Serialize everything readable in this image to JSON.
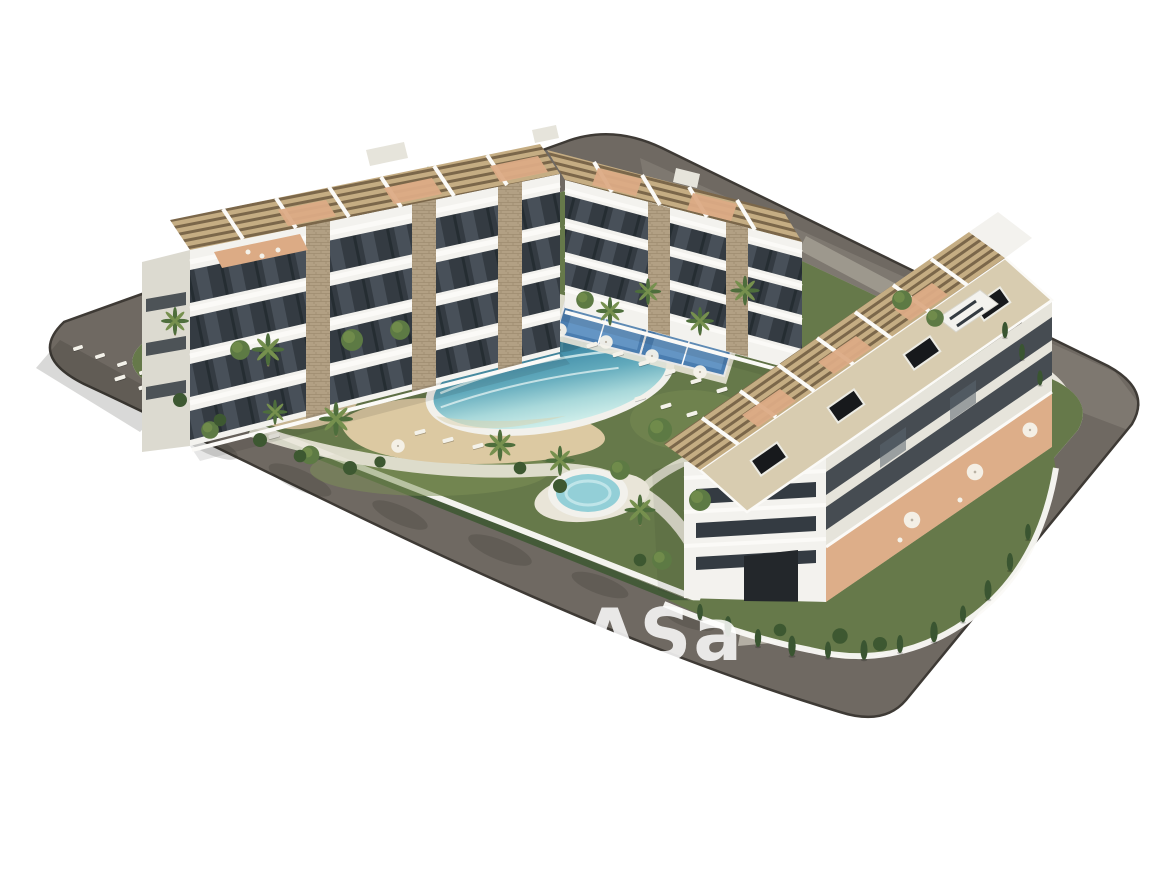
{
  "watermark": {
    "main": "cASa",
    "sub": "españa"
  },
  "scene": {
    "type": "3d-architectural-render",
    "view": "aerial",
    "subject": "residential apartment complex with communal lagoon pool, spa, paddle courts, gardens and perimeter road",
    "buildings": [
      "left-block",
      "back-block",
      "right-block"
    ],
    "amenities": [
      "lagoon-pool",
      "beach-deck",
      "spa-pool",
      "kidney-pool",
      "paddle-courts",
      "sun-loungers",
      "palm-garden"
    ]
  },
  "colors": {
    "bg": "#ffffff",
    "road": "#6f6962",
    "roadLight": "#8b857c",
    "roadEdge": "#3e3a35",
    "sidewalk": "#cdc5b5",
    "curb": "#e9e6dd",
    "plotBase": "#e9e5d8",
    "lawn": "#66794a",
    "lawnLight": "#7e9156",
    "shrub": "#3d5831",
    "sand": "#dcc9a2",
    "poolDeep": "#2f7d9e",
    "poolMid": "#62aabc",
    "poolPale": "#a8d8da",
    "poolRim": "#f2f1ec",
    "spaWater": "#93cfd7",
    "kidneyWater": "#a6d8dc",
    "courtBlue": "#4a7db0",
    "courtBlueLight": "#6e9dcb",
    "buildingWhite": "#f3f2ee",
    "buildingShade": "#e6e4db",
    "gableShade": "#dcdad0",
    "glassDark": "#343b42",
    "glassLight": "#5b6670",
    "slabWhite": "#fbfaf7",
    "stone": "#b2a084",
    "stoneDark": "#8f7e62",
    "pergola": "#c5ad83",
    "pergolaSlat": "#6e5a40",
    "terracotta": "#dcab85",
    "skylight": "#17191c",
    "roofBeige": "#d8ccb0",
    "dark": "#23272b",
    "ramp": "#b4afa4",
    "wallGray": "#a19b90",
    "trunk": "#93835f",
    "palm": "#4e6e3c",
    "palmLight": "#76904e",
    "cypress": "#3a5531",
    "treeGreen": "#5d7a44",
    "umbrella": "#f4f2ea",
    "watermark": "#ffffff"
  }
}
